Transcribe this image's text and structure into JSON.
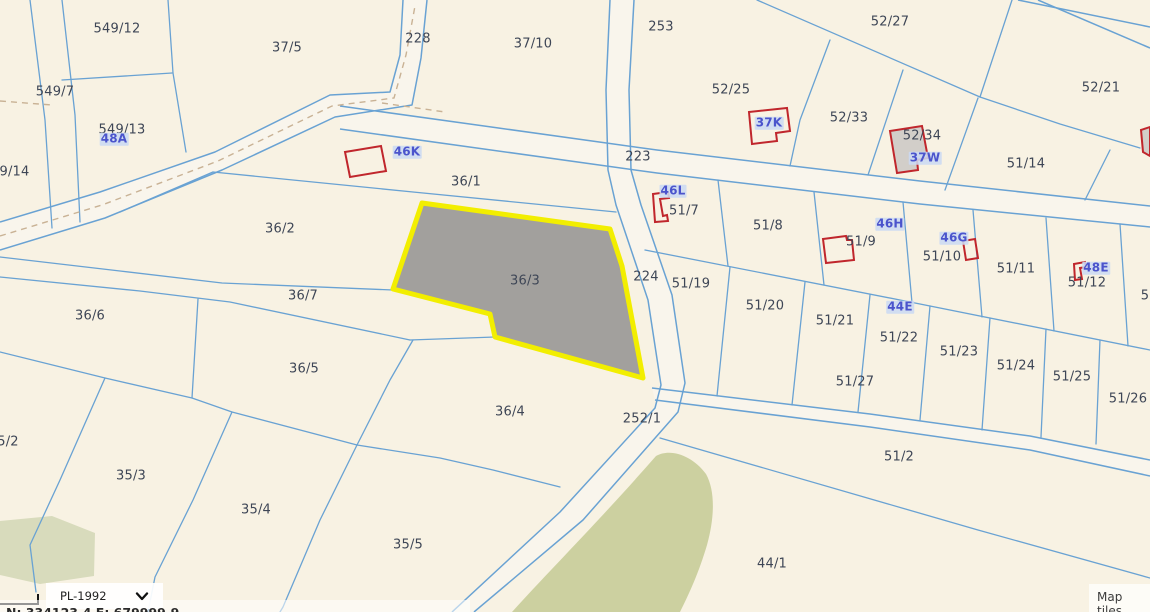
{
  "map": {
    "highlighted_parcel": "36/3",
    "colors": {
      "background": "#f8f2e3",
      "boundary_line": "#69a2d3",
      "parcel_label": "#3e4656",
      "building_outline": "#c0262c",
      "building_label": "#4b54cc",
      "highlight_fill": "#a2a09d",
      "highlight_outline": "#f2ee00",
      "greenery": "#ccd0a0"
    },
    "parcel_labels": [
      {
        "text": "549/12",
        "x": 117,
        "y": 29
      },
      {
        "text": "37/5",
        "x": 287,
        "y": 48
      },
      {
        "text": "549/7",
        "x": 55,
        "y": 92
      },
      {
        "text": "549/13",
        "x": 122,
        "y": 130
      },
      {
        "text": "549/14",
        "x": 6,
        "y": 172
      },
      {
        "text": "37/10",
        "x": 533,
        "y": 44
      },
      {
        "text": "52/27",
        "x": 890,
        "y": 22
      },
      {
        "text": "52/25",
        "x": 731,
        "y": 90
      },
      {
        "text": "52/21",
        "x": 1101,
        "y": 88
      },
      {
        "text": "52/33",
        "x": 849,
        "y": 118
      },
      {
        "text": "52/34",
        "x": 922,
        "y": 136
      },
      {
        "text": "51/14",
        "x": 1026,
        "y": 164
      },
      {
        "text": "36/1",
        "x": 466,
        "y": 182
      },
      {
        "text": "51/7",
        "x": 684,
        "y": 211
      },
      {
        "text": "51/8",
        "x": 768,
        "y": 226
      },
      {
        "text": "51/9",
        "x": 861,
        "y": 242
      },
      {
        "text": "51/10",
        "x": 942,
        "y": 257
      },
      {
        "text": "51/11",
        "x": 1016,
        "y": 269
      },
      {
        "text": "51/12",
        "x": 1087,
        "y": 283
      },
      {
        "text": "5",
        "x": 1145,
        "y": 296
      },
      {
        "text": "36/2",
        "x": 280,
        "y": 229
      },
      {
        "text": "36/7",
        "x": 303,
        "y": 296
      },
      {
        "text": "36/6",
        "x": 90,
        "y": 316
      },
      {
        "text": "36/5",
        "x": 304,
        "y": 369
      },
      {
        "text": "36/3",
        "x": 525,
        "y": 281
      },
      {
        "text": "36/4",
        "x": 510,
        "y": 412
      },
      {
        "text": "35/3",
        "x": 131,
        "y": 476
      },
      {
        "text": "35/4",
        "x": 256,
        "y": 510
      },
      {
        "text": "35/5",
        "x": 408,
        "y": 545
      },
      {
        "text": "5/2",
        "x": 8,
        "y": 442
      },
      {
        "text": "51/19",
        "x": 691,
        "y": 284
      },
      {
        "text": "51/20",
        "x": 765,
        "y": 306
      },
      {
        "text": "51/21",
        "x": 835,
        "y": 321
      },
      {
        "text": "51/22",
        "x": 899,
        "y": 338
      },
      {
        "text": "51/23",
        "x": 959,
        "y": 352
      },
      {
        "text": "51/24",
        "x": 1016,
        "y": 366
      },
      {
        "text": "51/25",
        "x": 1072,
        "y": 377
      },
      {
        "text": "51/26",
        "x": 1128,
        "y": 399
      },
      {
        "text": "51/27",
        "x": 855,
        "y": 382
      },
      {
        "text": "51/2",
        "x": 899,
        "y": 457
      },
      {
        "text": "44/1",
        "x": 772,
        "y": 564
      }
    ],
    "road_labels": [
      {
        "text": "228",
        "x": 418,
        "y": 39
      },
      {
        "text": "253",
        "x": 661,
        "y": 27
      },
      {
        "text": "223",
        "x": 638,
        "y": 157
      },
      {
        "text": "224",
        "x": 646,
        "y": 277
      },
      {
        "text": "252/1",
        "x": 642,
        "y": 419
      }
    ],
    "building_labels": [
      {
        "text": "48A",
        "x": 114,
        "y": 139
      },
      {
        "text": "46K",
        "x": 407,
        "y": 152
      },
      {
        "text": "37K",
        "x": 769,
        "y": 123
      },
      {
        "text": "37W",
        "x": 925,
        "y": 158
      },
      {
        "text": "46L",
        "x": 673,
        "y": 191
      },
      {
        "text": "46H",
        "x": 890,
        "y": 224
      },
      {
        "text": "46G",
        "x": 954,
        "y": 238
      },
      {
        "text": "44E",
        "x": 900,
        "y": 307
      },
      {
        "text": "48E",
        "x": 1096,
        "y": 268
      }
    ]
  },
  "controls": {
    "projection_value": "PL-1992",
    "map_tiles_label": "Map tiles",
    "coordinates_partial": "N: 334123.4   E: 679999.9"
  }
}
